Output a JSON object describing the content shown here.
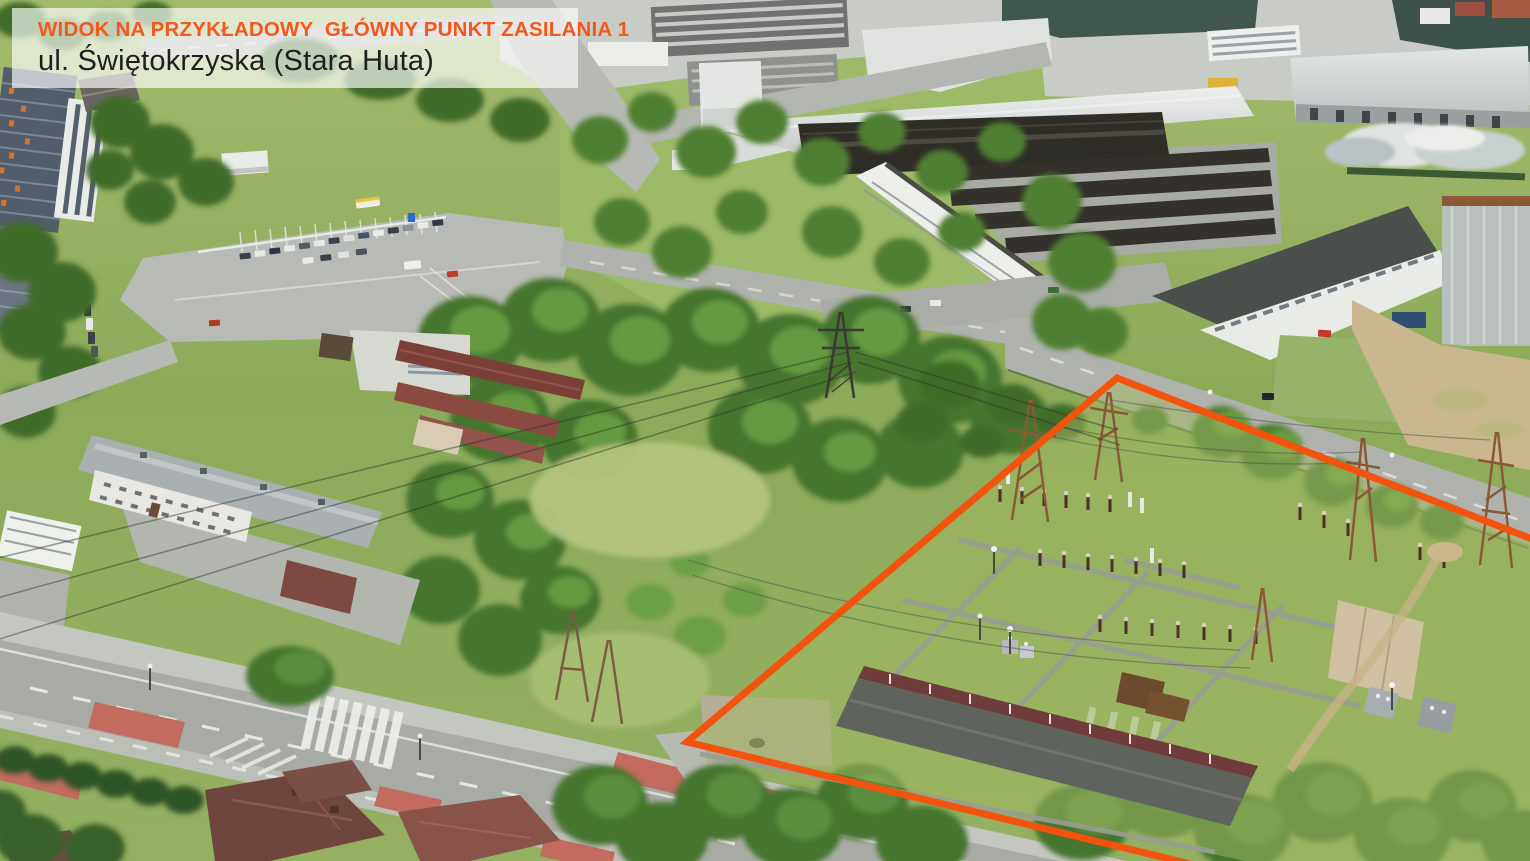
{
  "overlay": {
    "title": "WIDOK NA PRZYKŁADOWY  GŁÓWNY PUNKT ZASILANIA 1",
    "subtitle": "ul. Świętokrzyska (Stara Huta)",
    "title_color": "#F2591B",
    "subtitle_color": "#1E1E1E",
    "background": "rgba(255,255,255,0.66)"
  },
  "annotation": {
    "label": "gpz-site-boundary",
    "color": "#F4530E",
    "stroke_width": "7",
    "points_attr": "1545,544 1117,378 687,742 1232,874"
  }
}
